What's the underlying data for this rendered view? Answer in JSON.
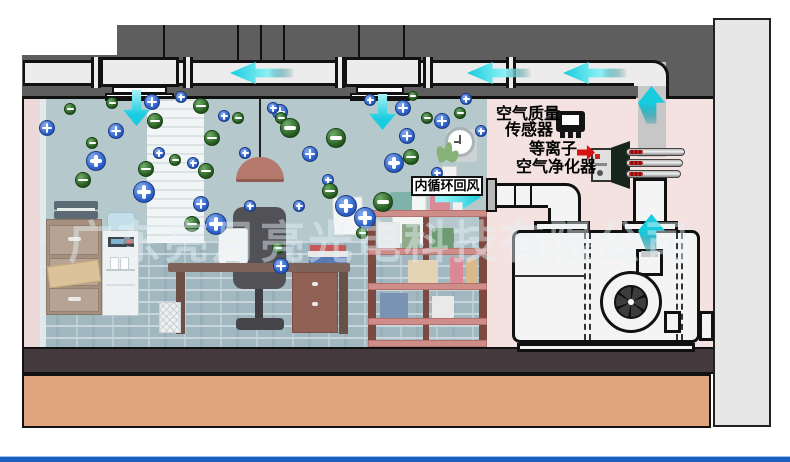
{
  "diagram": {
    "title_domain": "plasma air purifier office airflow schematic",
    "watermark": "广东亮月亮光电科技有限公司",
    "labels": {
      "air_quality_sensor_line1": "空气质量",
      "air_quality_sensor_line2": "传感器",
      "plasma_purifier_line1": "等离子",
      "plasma_purifier_line2": "空气净化器",
      "return_air": "内循环回风"
    },
    "colors": {
      "positive_ion": "#2e62c8",
      "negative_ion": "#275c22",
      "airflow_arrow": "#17ccdf",
      "pointer_arrow": "#d51212",
      "ceiling_slab": "#5e5e5e",
      "duct": "#ececec",
      "room_wall": "#b5c8cc",
      "machine_room_wall": "#f3e2df",
      "floor": "#453a3d",
      "ground": "#e0a47e",
      "bottom_rule": "#1b5fc1"
    },
    "airflow_arrows": [
      {
        "dir": "left",
        "x": 230,
        "y": 73
      },
      {
        "dir": "left",
        "x": 467,
        "y": 73
      },
      {
        "dir": "left",
        "x": 563,
        "y": 73
      },
      {
        "dir": "down",
        "x": 136,
        "y": 126
      },
      {
        "dir": "down",
        "x": 382,
        "y": 130
      },
      {
        "dir": "up",
        "x": 651,
        "y": 86
      },
      {
        "dir": "up",
        "x": 651,
        "y": 214
      },
      {
        "dir": "right",
        "x": 481,
        "y": 197
      },
      {
        "dir": "red",
        "x": 595,
        "y": 153
      }
    ],
    "particles": [
      {
        "t": "pos",
        "x": 152,
        "y": 102,
        "r": 8
      },
      {
        "t": "pos",
        "x": 181,
        "y": 97,
        "r": 6
      },
      {
        "t": "pos",
        "x": 224,
        "y": 116,
        "r": 6
      },
      {
        "t": "pos",
        "x": 280,
        "y": 112,
        "r": 8
      },
      {
        "t": "pos",
        "x": 116,
        "y": 131,
        "r": 8
      },
      {
        "t": "pos",
        "x": 96,
        "y": 161,
        "r": 10
      },
      {
        "t": "pos",
        "x": 159,
        "y": 153,
        "r": 6
      },
      {
        "t": "pos",
        "x": 193,
        "y": 163,
        "r": 6
      },
      {
        "t": "pos",
        "x": 273,
        "y": 108,
        "r": 6
      },
      {
        "t": "pos",
        "x": 310,
        "y": 154,
        "r": 8
      },
      {
        "t": "pos",
        "x": 328,
        "y": 180,
        "r": 6
      },
      {
        "t": "pos",
        "x": 346,
        "y": 206,
        "r": 11
      },
      {
        "t": "pos",
        "x": 365,
        "y": 218,
        "r": 11
      },
      {
        "t": "pos",
        "x": 299,
        "y": 206,
        "r": 6
      },
      {
        "t": "pos",
        "x": 281,
        "y": 266,
        "r": 8
      },
      {
        "t": "pos",
        "x": 216,
        "y": 224,
        "r": 11
      },
      {
        "t": "pos",
        "x": 201,
        "y": 204,
        "r": 8
      },
      {
        "t": "pos",
        "x": 250,
        "y": 206,
        "r": 6
      },
      {
        "t": "pos",
        "x": 403,
        "y": 108,
        "r": 8
      },
      {
        "t": "pos",
        "x": 442,
        "y": 121,
        "r": 8
      },
      {
        "t": "pos",
        "x": 407,
        "y": 136,
        "r": 8
      },
      {
        "t": "pos",
        "x": 394,
        "y": 163,
        "r": 10
      },
      {
        "t": "pos",
        "x": 466,
        "y": 99,
        "r": 6
      },
      {
        "t": "pos",
        "x": 481,
        "y": 131,
        "r": 6
      },
      {
        "t": "pos",
        "x": 47,
        "y": 128,
        "r": 8
      },
      {
        "t": "pos",
        "x": 144,
        "y": 192,
        "r": 11
      },
      {
        "t": "pos",
        "x": 245,
        "y": 153,
        "r": 6
      },
      {
        "t": "pos",
        "x": 370,
        "y": 100,
        "r": 6
      },
      {
        "t": "pos",
        "x": 437,
        "y": 173,
        "r": 6
      },
      {
        "t": "neg",
        "x": 112,
        "y": 103,
        "r": 6
      },
      {
        "t": "neg",
        "x": 155,
        "y": 121,
        "r": 8
      },
      {
        "t": "neg",
        "x": 238,
        "y": 118,
        "r": 6
      },
      {
        "t": "neg",
        "x": 92,
        "y": 143,
        "r": 6
      },
      {
        "t": "neg",
        "x": 146,
        "y": 169,
        "r": 8
      },
      {
        "t": "neg",
        "x": 175,
        "y": 160,
        "r": 6
      },
      {
        "t": "neg",
        "x": 206,
        "y": 171,
        "r": 8
      },
      {
        "t": "neg",
        "x": 201,
        "y": 106,
        "r": 8
      },
      {
        "t": "neg",
        "x": 281,
        "y": 118,
        "r": 6
      },
      {
        "t": "neg",
        "x": 290,
        "y": 128,
        "r": 10
      },
      {
        "t": "neg",
        "x": 336,
        "y": 138,
        "r": 10
      },
      {
        "t": "neg",
        "x": 330,
        "y": 191,
        "r": 8
      },
      {
        "t": "neg",
        "x": 383,
        "y": 202,
        "r": 10
      },
      {
        "t": "neg",
        "x": 362,
        "y": 233,
        "r": 6
      },
      {
        "t": "neg",
        "x": 278,
        "y": 248,
        "r": 6
      },
      {
        "t": "neg",
        "x": 192,
        "y": 224,
        "r": 8
      },
      {
        "t": "neg",
        "x": 427,
        "y": 118,
        "r": 6
      },
      {
        "t": "neg",
        "x": 411,
        "y": 157,
        "r": 8
      },
      {
        "t": "neg",
        "x": 70,
        "y": 109,
        "r": 6
      },
      {
        "t": "neg",
        "x": 83,
        "y": 180,
        "r": 8
      },
      {
        "t": "neg",
        "x": 212,
        "y": 138,
        "r": 8
      },
      {
        "t": "neg",
        "x": 413,
        "y": 96,
        "r": 5
      },
      {
        "t": "neg",
        "x": 460,
        "y": 113,
        "r": 6
      }
    ]
  }
}
